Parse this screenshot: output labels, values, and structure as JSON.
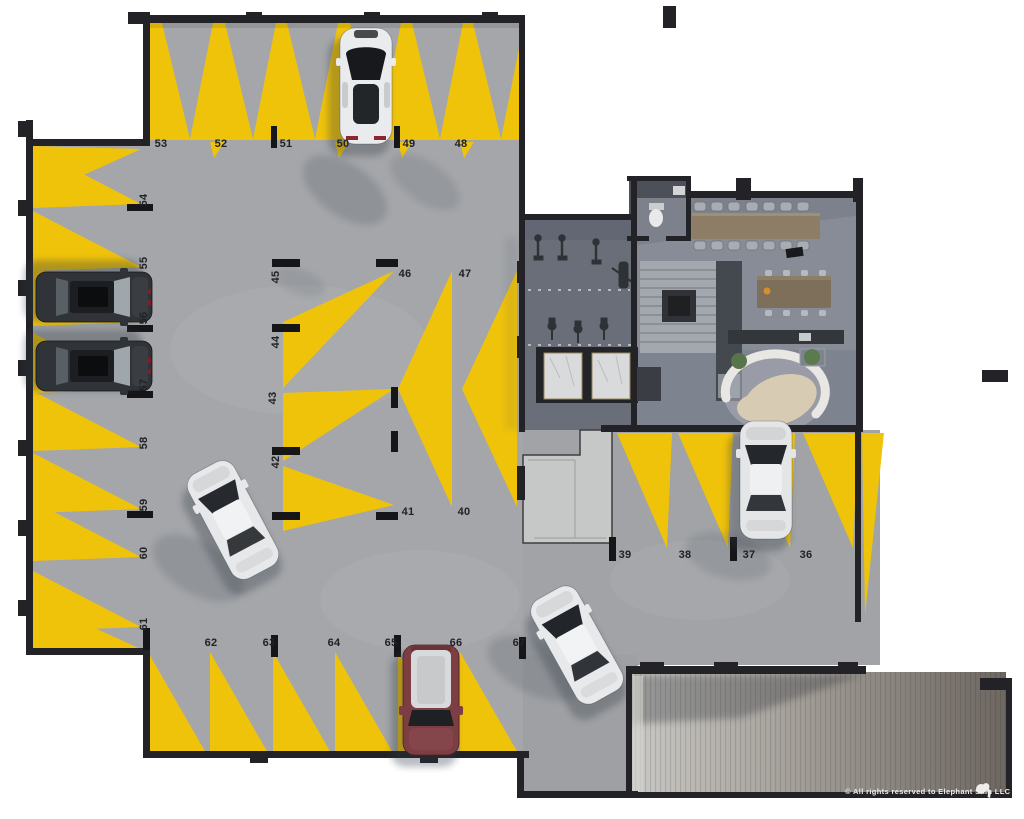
{
  "parking_spaces": {
    "s36": "36",
    "s37": "37",
    "s38": "38",
    "s39": "39",
    "s40": "40",
    "s41": "41",
    "s42": "42",
    "s43": "43",
    "s44": "44",
    "s45": "45",
    "s46": "46",
    "s47": "47",
    "s48": "48",
    "s49": "49",
    "s50": "50",
    "s51": "51",
    "s52": "52",
    "s53": "53",
    "s54": "54",
    "s55": "55",
    "s56": "56",
    "s57": "57",
    "s58": "58",
    "s59": "59",
    "s60": "60",
    "s61": "61",
    "s62": "62",
    "s63": "63",
    "s64": "64",
    "s65": "65",
    "s66": "66",
    "s67": "67"
  },
  "footer": {
    "copyright": "© All rights reserved to Elephant Skin LLC"
  },
  "colors": {
    "marking_yellow": "#f0c30b",
    "floor_concrete": "#a4a6a9",
    "amenity_floor": "#878c96",
    "gym_floor": "#696e78",
    "wall": "#232327",
    "ramp_dark": "#6e6761"
  }
}
